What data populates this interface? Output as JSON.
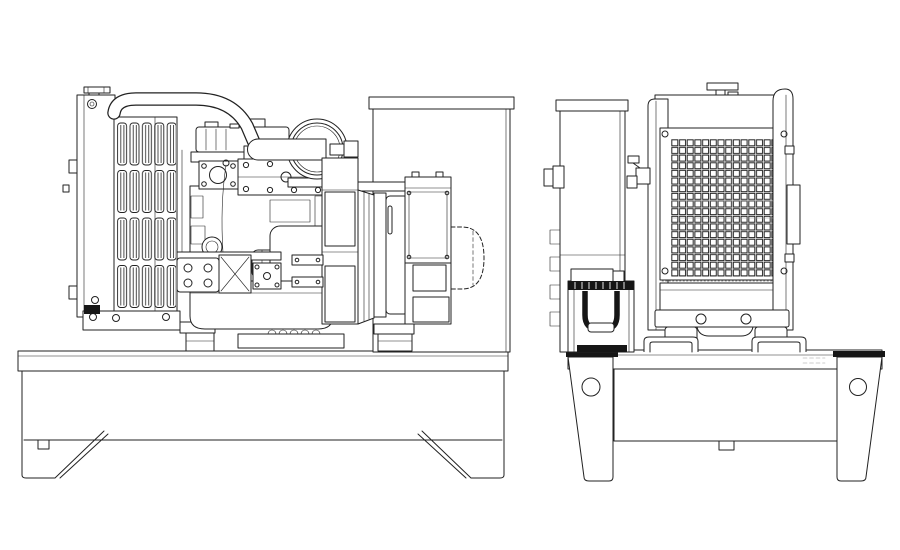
{
  "meta": {
    "document_type": "engineering line drawing",
    "subject": "open-frame diesel generator set (engine, radiator, alternator on skid base)",
    "visible_text": "none",
    "views": [
      {
        "id": "side",
        "label": "Side elevation view"
      },
      {
        "id": "end",
        "label": "End elevation view"
      }
    ]
  },
  "palette": {
    "background": "#ffffff",
    "line": "#222222",
    "line_light": "#9a9a9a",
    "fill_dark": "#161616",
    "fill_white": "#ffffff"
  },
  "components": {
    "side_view": [
      "radiator",
      "radiator-cap",
      "upper-coolant-hose",
      "radiator-fin-slots",
      "engine-block",
      "valve-cover",
      "intake-manifold",
      "air-cleaner",
      "intake-pipe",
      "oil-filter",
      "starter-motor",
      "oil-pan",
      "flywheel-housing",
      "alternator",
      "alternator-vents",
      "alternator-terminal-box",
      "hidden-coupling-outline",
      "rear-panel",
      "base-frame",
      "skid-legs"
    ],
    "end_view": [
      "control-panel-edge",
      "panel-connector",
      "battery",
      "battery-handle",
      "radiator-frame",
      "radiator-grille-mesh",
      "radiator-cap",
      "drain-fitting",
      "side-bracket",
      "engine-sump",
      "vibration-mounts",
      "base-frame",
      "mounting-legs",
      "lifting-holes"
    ]
  }
}
